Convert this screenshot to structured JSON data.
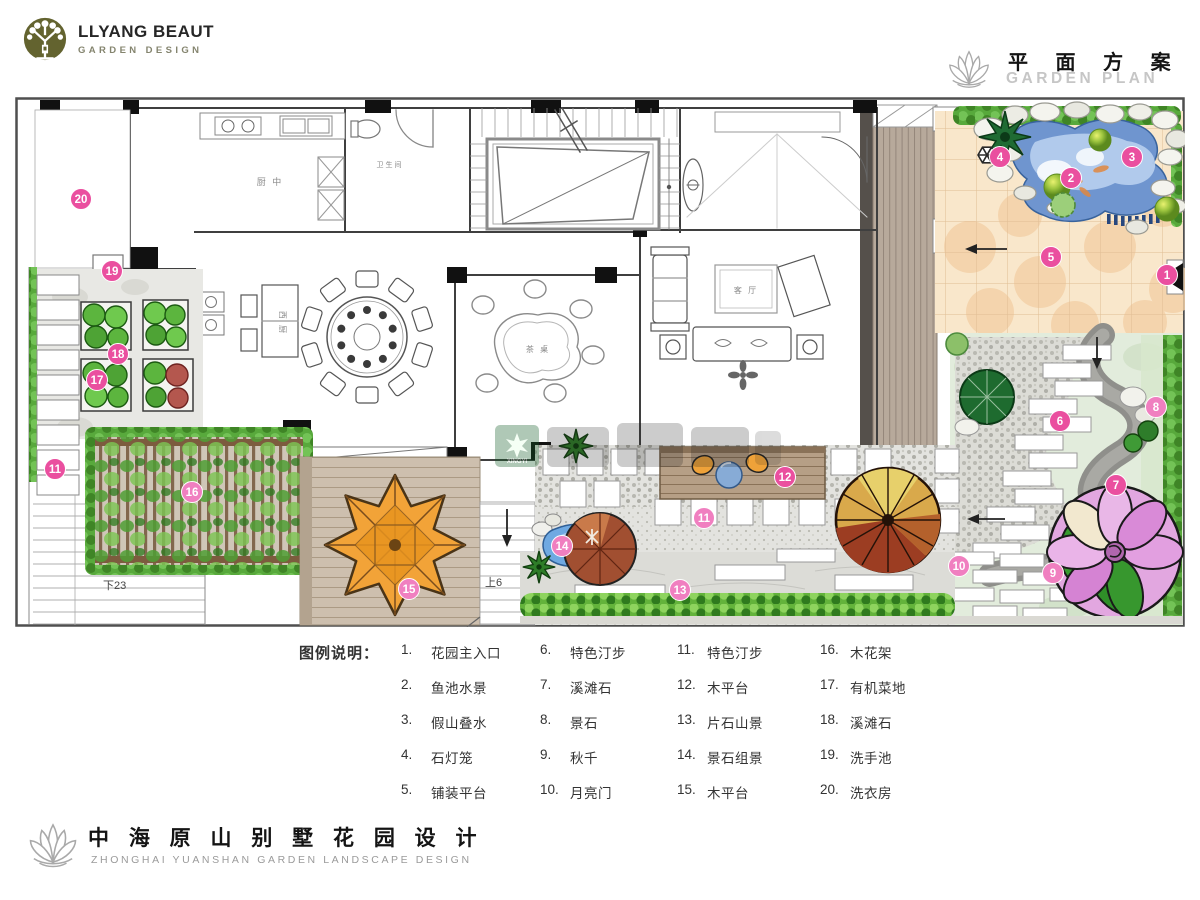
{
  "header": {
    "logo": {
      "line1": "LLYANG BEAUT",
      "line2": "GARDEN DESIGN"
    },
    "plan_title_cn": "平 面 方 案",
    "plan_title_en": "GARDEN PLAN"
  },
  "footer": {
    "title_cn": "中 海 原 山 别 墅 花 园 设 计",
    "title_en": "ZHONGHAI YUANSHAN GARDEN LANDSCAPE DESIGN"
  },
  "legend": {
    "heading": "图例说明：",
    "items": [
      {
        "num": "1.",
        "label": "花园主入口"
      },
      {
        "num": "2.",
        "label": "鱼池水景"
      },
      {
        "num": "3.",
        "label": "假山叠水"
      },
      {
        "num": "4.",
        "label": "石灯笼"
      },
      {
        "num": "5.",
        "label": "铺装平台"
      },
      {
        "num": "6.",
        "label": "特色汀步"
      },
      {
        "num": "7.",
        "label": "溪滩石"
      },
      {
        "num": "8.",
        "label": "景石"
      },
      {
        "num": "9.",
        "label": "秋千"
      },
      {
        "num": "10.",
        "label": "月亮门"
      },
      {
        "num": "11.",
        "label": "特色汀步"
      },
      {
        "num": "12.",
        "label": "木平台"
      },
      {
        "num": "13.",
        "label": "片石山景"
      },
      {
        "num": "14.",
        "label": "景石组景"
      },
      {
        "num": "15.",
        "label": "木平台"
      },
      {
        "num": "16.",
        "label": "木花架"
      },
      {
        "num": "17.",
        "label": "有机菜地"
      },
      {
        "num": "18.",
        "label": "溪滩石"
      },
      {
        "num": "19.",
        "label": "洗手池"
      },
      {
        "num": "20.",
        "label": "洗衣房"
      }
    ]
  },
  "plan": {
    "watermark_text": "XINGYI",
    "marker_colors": {
      "solid": "#ea4f9f",
      "light": "#f07fc0"
    },
    "markers": [
      {
        "n": "1",
        "x": 1152,
        "y": 178,
        "tone": "solid"
      },
      {
        "n": "2",
        "x": 1056,
        "y": 81,
        "tone": "solid"
      },
      {
        "n": "3",
        "x": 1117,
        "y": 60,
        "tone": "solid"
      },
      {
        "n": "4",
        "x": 985,
        "y": 60,
        "tone": "solid"
      },
      {
        "n": "5",
        "x": 1036,
        "y": 160,
        "tone": "solid"
      },
      {
        "n": "6",
        "x": 1045,
        "y": 324,
        "tone": "solid"
      },
      {
        "n": "7",
        "x": 1101,
        "y": 388,
        "tone": "solid"
      },
      {
        "n": "8",
        "x": 1141,
        "y": 310,
        "tone": "light"
      },
      {
        "n": "9",
        "x": 1038,
        "y": 476,
        "tone": "light"
      },
      {
        "n": "10",
        "x": 944,
        "y": 469,
        "tone": "light"
      },
      {
        "n": "11",
        "x": 40,
        "y": 372,
        "tone": "solid"
      },
      {
        "n": "11",
        "x": 689,
        "y": 421,
        "tone": "light"
      },
      {
        "n": "12",
        "x": 770,
        "y": 380,
        "tone": "solid"
      },
      {
        "n": "13",
        "x": 665,
        "y": 493,
        "tone": "light"
      },
      {
        "n": "14",
        "x": 547,
        "y": 449,
        "tone": "light"
      },
      {
        "n": "15",
        "x": 394,
        "y": 492,
        "tone": "light"
      },
      {
        "n": "16",
        "x": 177,
        "y": 395,
        "tone": "light"
      },
      {
        "n": "17",
        "x": 82,
        "y": 283,
        "tone": "solid"
      },
      {
        "n": "18",
        "x": 103,
        "y": 257,
        "tone": "solid"
      },
      {
        "n": "19",
        "x": 97,
        "y": 174,
        "tone": "solid"
      },
      {
        "n": "20",
        "x": 66,
        "y": 102,
        "tone": "solid"
      }
    ],
    "stair_labels": [
      {
        "text": "下23",
        "x": 88,
        "y": 492
      },
      {
        "text": "上6",
        "x": 470,
        "y": 489
      }
    ],
    "room_labels": [
      {
        "text": "厨 中",
        "x": 255,
        "y": 88,
        "size": 9
      },
      {
        "text": "卫生间",
        "x": 375,
        "y": 70,
        "size": 7
      },
      {
        "text": "西 厨",
        "x": 265,
        "y": 226,
        "size": 8,
        "vertical": true
      },
      {
        "text": "茶 桌",
        "x": 523,
        "y": 255,
        "size": 8
      },
      {
        "text": "客 厅",
        "x": 731,
        "y": 196,
        "size": 8
      }
    ]
  }
}
